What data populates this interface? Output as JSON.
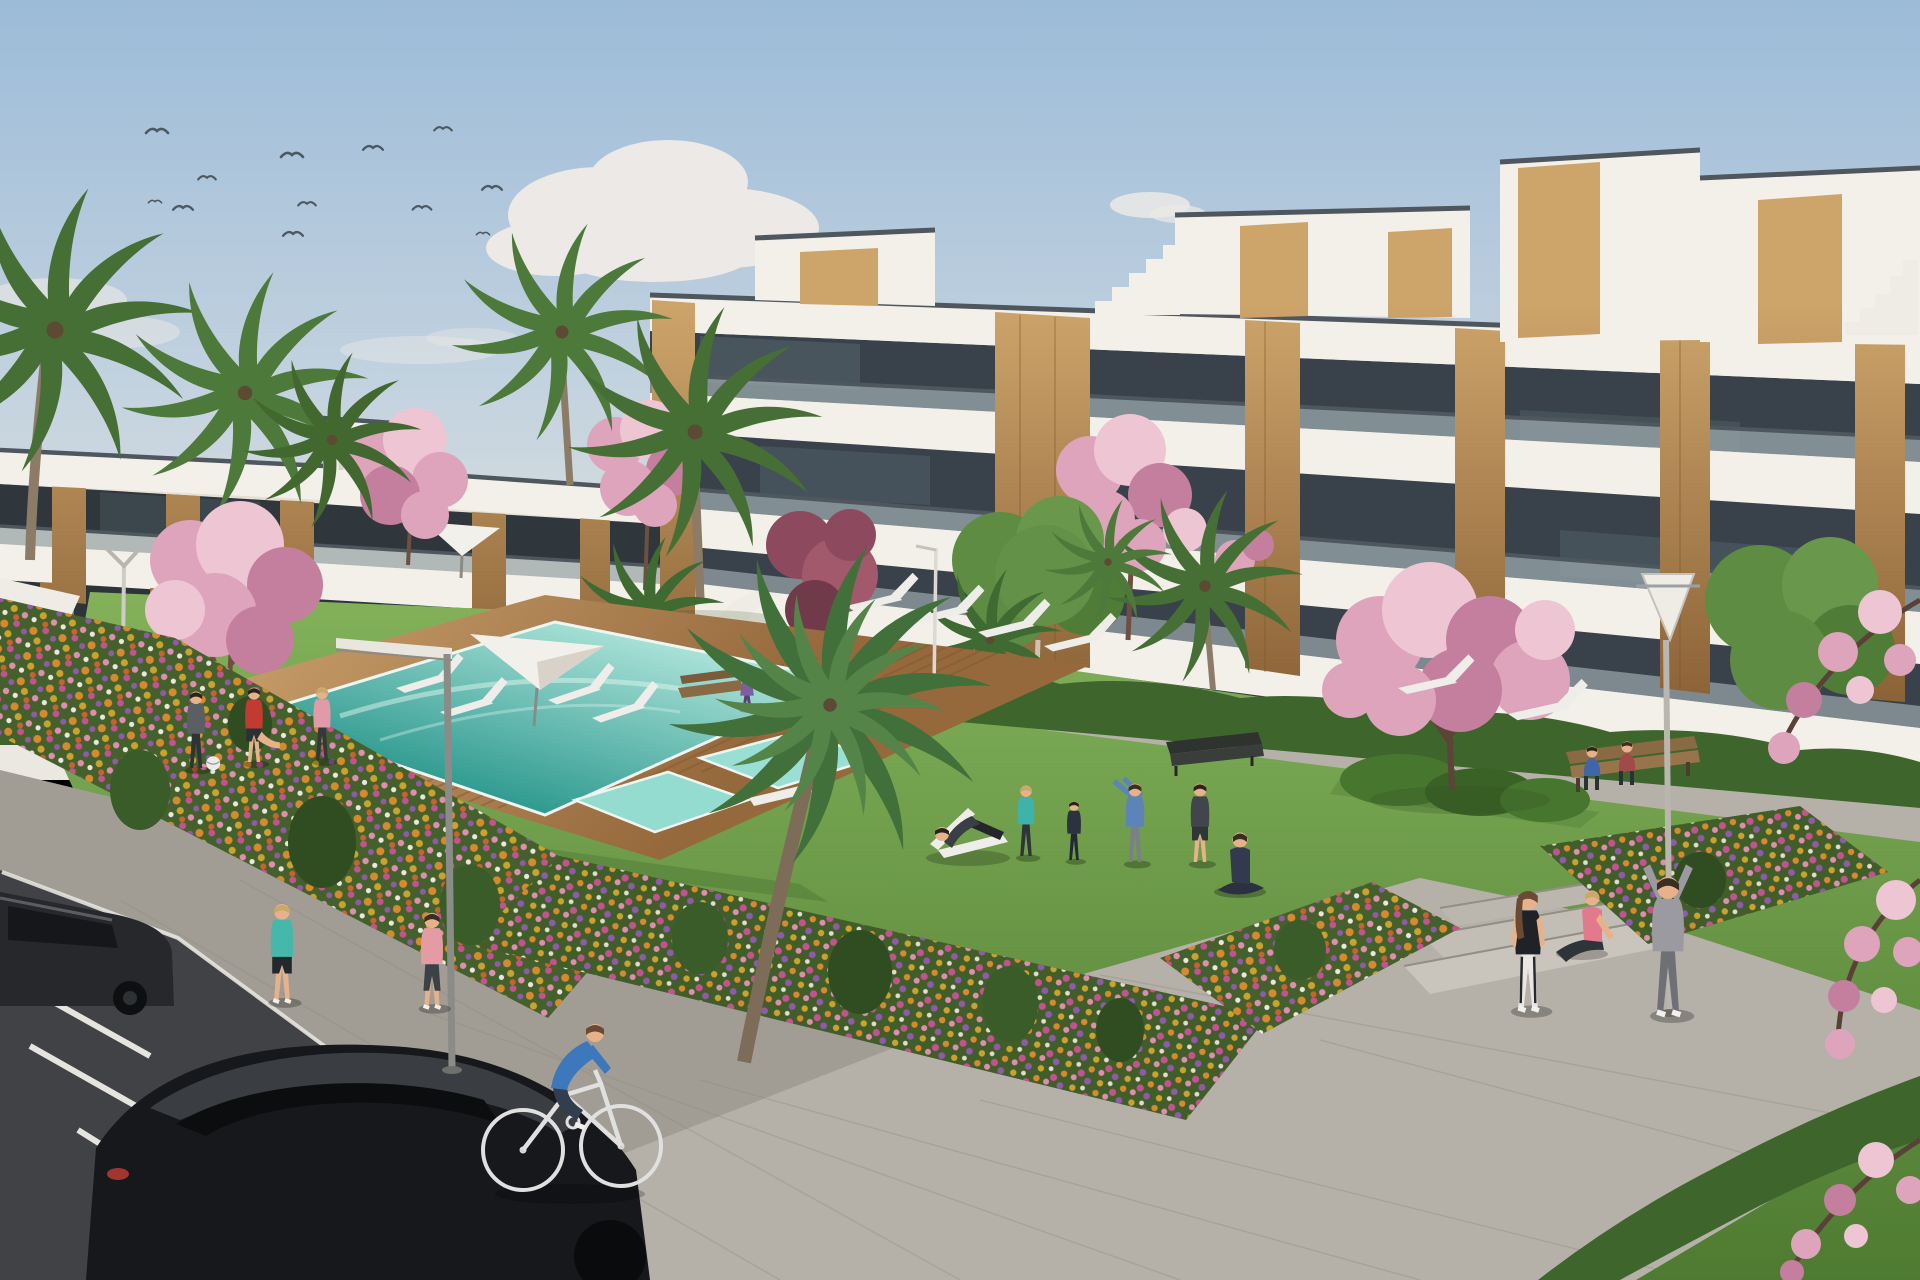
{
  "scene": {
    "type": "architectural-render",
    "description": "Sunny 3D visualization of a modern white apartment complex with wood accents, communal lawn, turquoise swimming pool on a wooden deck, flower beds, palm and cherry-blossom trees, residents exercising, jogging and cycling, and dark cars parked on the street in the foreground.",
    "sky": {
      "top": "#9cbbd8",
      "mid": "#c2d2df",
      "horizon": "#e4e4de"
    },
    "palette": {
      "cloud": "#ece9e6",
      "bird": "#4c5862",
      "building_white": "#f3f0ea",
      "building_shade": "#e5dfd4",
      "glass": "#39424a",
      "glass_reflect": "#5b6c75",
      "glass_rail": "#9aa8ad",
      "roof_trim": "#4e565e",
      "wood_light": "#cda56b",
      "wood_dark": "#8a6136",
      "grass_light": "#85b45c",
      "grass_dark": "#4e7b31",
      "hedge": "#3e662c",
      "pool_far": "#b5e8de",
      "pool_near": "#2f9a90",
      "deck_light": "#c49a67",
      "deck_dark": "#96693d",
      "path": "#b5b1a8",
      "pavement": "#a19d95",
      "road": "#414246",
      "marking": "#e6e4de",
      "blossom": "#dea4bb",
      "blossom_light": "#eec6d3",
      "blossom_deep": "#c57f9e",
      "maroon_tree": "#8d4a5f",
      "palm_green": "#466f35",
      "trunk": "#8b7b67",
      "skin": "#e6b28c",
      "flower_orange": "#d68a2e",
      "flower_magenta": "#c2538f",
      "flower_purple": "#8f5aa8",
      "flower_gold": "#caa22e",
      "flower_pink": "#de8fae"
    },
    "counts": {
      "birds": 12,
      "palm_trees": 10,
      "blossom_trees": 7,
      "red_ornamental_trees": 1,
      "green_trees": 2,
      "sun_loungers": 10,
      "deck_chairs": 2,
      "umbrellas": 2,
      "street_lamps": 4,
      "benches": 3,
      "parked_cars": 2,
      "people": 18,
      "pools": 3,
      "flower_beds": 4
    },
    "people": [
      {
        "label": "jogger in teal",
        "shirt": "#46b8ab",
        "pants": "#23282c"
      },
      {
        "label": "jogger in pink",
        "shirt": "#e59ba4",
        "pants": "#3c4148"
      },
      {
        "label": "cyclist in blue",
        "shirt": "#3d78bd",
        "pants": "#323d4e"
      },
      {
        "label": "man with ball",
        "shirt": "#5a5f63",
        "pants": "#2e3338"
      },
      {
        "label": "man stretching in red",
        "shirt": "#c23b31",
        "pants": "#2b3035"
      },
      {
        "label": "woman in pink on lawn",
        "shirt": "#e09aa8",
        "pants": "#33383e"
      },
      {
        "label": "woman in purple by pool",
        "shirt": "#7b5fa0",
        "pants": "#58436f"
      },
      {
        "label": "man on deckchair",
        "shirt": "#3a3f45",
        "pants": "#23272b"
      },
      {
        "label": "woman in teal sportswear",
        "shirt": "#3fb3a9",
        "pants": "#2e3438"
      },
      {
        "label": "child in dark hoodie",
        "shirt": "#2c3240",
        "pants": "#232834"
      },
      {
        "label": "man stretching in blue",
        "shirt": "#5d84b8",
        "pants": "#7b8086"
      },
      {
        "label": "man in dark t-shirt",
        "shirt": "#41464c",
        "pants": "#303539"
      },
      {
        "label": "woman doing yoga",
        "shirt": "#333a4d",
        "pants": "#2b3140"
      },
      {
        "label": "woman in black top",
        "shirt": "#1f2327",
        "pants": "#e9e7e3"
      },
      {
        "label": "woman seated in pink",
        "shirt": "#e2798c",
        "pants": "#2f343a"
      },
      {
        "label": "man in grey tracksuit",
        "shirt": "#9a9aa0",
        "pants": "#6f7076"
      },
      {
        "label": "person on bench in blue",
        "shirt": "#3f66a8",
        "pants": "#2c3136"
      },
      {
        "label": "person on bench in red",
        "shirt": "#a04a4a",
        "pants": "#2c3136"
      }
    ],
    "vehicles": [
      {
        "label": "dark parked car at left edge",
        "color": "#26282b"
      },
      {
        "label": "black hatchback in foreground",
        "color": "#17181b"
      }
    ],
    "buildings": [
      {
        "label": "left two-storey apartment block",
        "floors": 2
      },
      {
        "label": "right four-storey apartment block with penthouses",
        "floors": 4
      }
    ]
  }
}
